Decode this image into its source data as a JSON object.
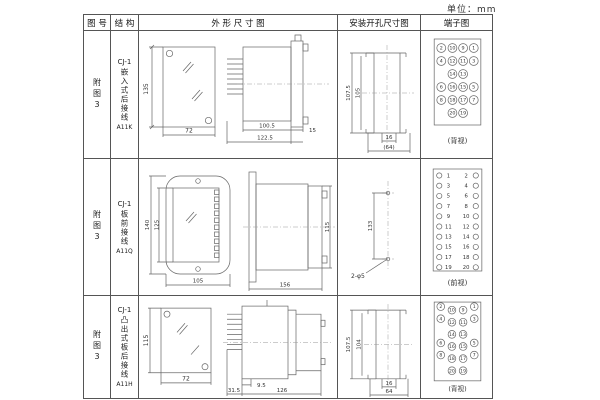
{
  "unit": "单位：mm",
  "header": {
    "fig_no": "图 号",
    "structure": "结 构",
    "outline": "外 形 尺 寸 图",
    "install": "安装开孔尺寸图",
    "terminal": "端子图"
  },
  "rows": [
    {
      "fig": "附图3",
      "structure": {
        "model": "CJ-1",
        "desc": "嵌入式后接线",
        "code": "A11K"
      },
      "outline": {
        "front_h": "135",
        "front_w": "72",
        "dim_a": "100.5",
        "dim_b": "122.5",
        "dim_c": "15"
      },
      "install": {
        "v_outer": "107.5",
        "v_inner": "105",
        "h_inner": "16",
        "h_outer": "(64)"
      },
      "terminal": {
        "caption": "(背视)",
        "pins": [
          2,
          10,
          9,
          1,
          4,
          12,
          11,
          3,
          14,
          13,
          6,
          16,
          15,
          5,
          8,
          18,
          17,
          7,
          20,
          19
        ]
      }
    },
    {
      "fig": "附图3",
      "structure": {
        "model": "CJ-1",
        "desc": "板前接线",
        "code": "A11Q"
      },
      "outline": {
        "front_h_outer": "140",
        "front_h_inner": "125",
        "front_w": "105",
        "side_len": "156",
        "side_h": "115"
      },
      "install": {
        "v": "133",
        "hole_label": "2-φ5"
      },
      "terminal": {
        "caption": "(前视)",
        "left_pins": [
          1,
          3,
          5,
          7,
          9,
          11,
          13,
          15,
          17,
          19
        ],
        "right_pins": [
          2,
          4,
          6,
          8,
          10,
          12,
          14,
          16,
          18,
          20
        ]
      }
    },
    {
      "fig": "附图3",
      "structure": {
        "model": "CJ-1",
        "desc": "凸出式板后接线",
        "code": "A11H"
      },
      "outline": {
        "front_h": "115",
        "front_w": "72",
        "dim_a": "9.5",
        "dim_b": "31.5",
        "dim_c": "126"
      },
      "install": {
        "v_outer": "107.5",
        "v_inner": "104",
        "h_inner": "16",
        "h_outer": "64"
      },
      "terminal": {
        "caption": "(背视)",
        "pins": [
          2,
          10,
          9,
          1,
          4,
          12,
          11,
          3,
          14,
          13,
          6,
          16,
          15,
          5,
          8,
          18,
          17,
          7,
          20,
          19
        ]
      }
    }
  ]
}
